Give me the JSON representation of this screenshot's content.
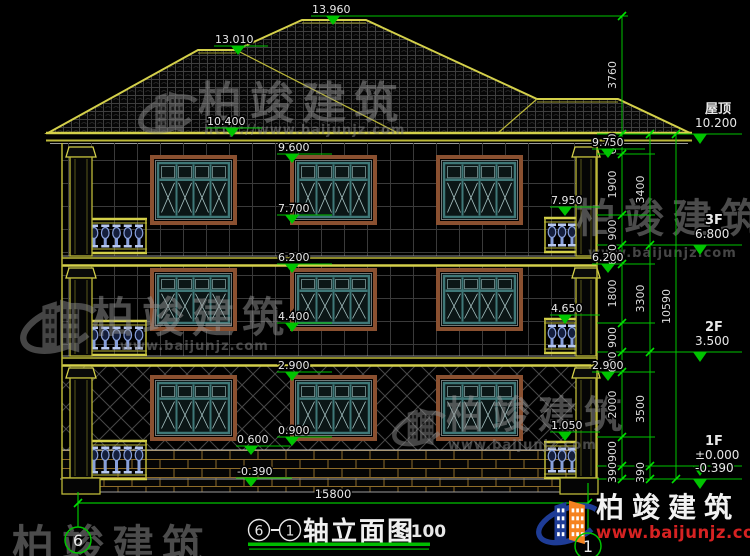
{
  "canvas": {
    "width": 750,
    "height": 556,
    "background": "#000000"
  },
  "colors": {
    "dim_green": "#00c400",
    "tick_green": "#00e000",
    "outline_yellow": "#bcb838",
    "bright_yellow": "#d4d04a",
    "text_white": "#e8e8e8",
    "frame_brown": "#8a5030",
    "sash_teal": "#3f7878",
    "pane_fill": "#0b1616",
    "mullion_light": "#a8c4c4",
    "wall_grid": "#3a3a3a",
    "hatch_grey": "#4a4a4a",
    "roof_tile": "#3e3e3e",
    "brick_mortar": "#8f6d2a",
    "baluster_blue": "#88a0dc",
    "baluster_light": "#b8c8ee",
    "watermark_grey": "#969696",
    "brand_red": "#d62222",
    "brand_blue": "#1e3c96",
    "brand_orange": "#f5821f"
  },
  "title_block": {
    "axis_start": "6",
    "axis_end": "1",
    "separator": "-",
    "title": "轴立面图",
    "scale": "1:100"
  },
  "brand": {
    "name": "柏竣建筑",
    "url": "www.baijunjz.com"
  },
  "watermarks": [
    {
      "text": "柏竣建筑",
      "url": "http://www.baijunjz.com",
      "x": 198,
      "y": 118,
      "size": 44,
      "url_x": 204,
      "url_y": 134,
      "logo": {
        "x": 138,
        "y": 78,
        "s": 0.62
      }
    },
    {
      "text": "柏竣建筑",
      "url": "www.baijunjz.com",
      "x": 92,
      "y": 332,
      "size": 42,
      "url_x": 120,
      "url_y": 350,
      "logo": {
        "x": 20,
        "y": 282,
        "s": 0.8
      }
    },
    {
      "text": "柏竣建筑",
      "url": "www.baijunjz.com",
      "x": 576,
      "y": 232,
      "size": 40,
      "url_x": 588,
      "url_y": 257
    },
    {
      "text": "柏竣建筑",
      "url": "www.baijunjz.com",
      "x": 446,
      "y": 428,
      "size": 38,
      "url_x": 448,
      "url_y": 449,
      "logo": {
        "x": 392,
        "y": 396,
        "s": 0.56
      }
    },
    {
      "text": "柏竣建筑",
      "url": "",
      "x": 12,
      "y": 560,
      "size": 42
    }
  ],
  "elevation_markers": [
    {
      "t": "13.960",
      "y": 16,
      "ax": 333,
      "x1": 311,
      "x2": 368,
      "tx": 312
    },
    {
      "t": "13.010",
      "y": 46,
      "ax": 238,
      "x1": 214,
      "x2": 268,
      "tx": 215
    },
    {
      "t": "10.400",
      "y": 128,
      "ax": 232,
      "x1": 206,
      "x2": 262,
      "tx": 207
    },
    {
      "t": "9.600",
      "y": 154,
      "ax": 292,
      "x1": 277,
      "x2": 332,
      "tx": 278
    },
    {
      "t": "7.700",
      "y": 215,
      "ax": 292,
      "x1": 277,
      "x2": 332,
      "tx": 278
    },
    {
      "t": "6.200",
      "y": 264,
      "ax": 292,
      "x1": 277,
      "x2": 332,
      "tx": 278
    },
    {
      "t": "4.400",
      "y": 323,
      "ax": 292,
      "x1": 277,
      "x2": 332,
      "tx": 278
    },
    {
      "t": "2.900",
      "y": 372,
      "ax": 292,
      "x1": 277,
      "x2": 332,
      "tx": 278
    },
    {
      "t": "0.900",
      "y": 437,
      "ax": 292,
      "x1": 277,
      "x2": 332,
      "tx": 278
    },
    {
      "t": "0.600",
      "y": 446,
      "ax": 251,
      "x1": 236,
      "x2": 290,
      "tx": 237
    },
    {
      "t": "-0.390",
      "y": 478,
      "ax": 251,
      "x1": 236,
      "x2": 292,
      "tx": 237
    },
    {
      "t": "7.950",
      "y": 207,
      "ax": 565,
      "x1": 550,
      "x2": 600,
      "tx": 551
    },
    {
      "t": "4.650",
      "y": 315,
      "ax": 565,
      "x1": 550,
      "x2": 600,
      "tx": 551
    },
    {
      "t": "1.050",
      "y": 432,
      "ax": 565,
      "x1": 550,
      "x2": 600,
      "tx": 551
    },
    {
      "t": "9.750",
      "y": 149,
      "ax": 608,
      "x1": 592,
      "x2": 645,
      "tx": 592
    },
    {
      "t": "6.200",
      "y": 264,
      "ax": 608,
      "x1": 592,
      "x2": 645,
      "tx": 592
    },
    {
      "t": "2.900",
      "y": 372,
      "ax": 608,
      "x1": 592,
      "x2": 645,
      "tx": 592
    }
  ],
  "floor_levels": [
    {
      "name": "屋顶",
      "value": "10.200",
      "y": 134
    },
    {
      "name": "3F",
      "value": "6.800",
      "y": 245
    },
    {
      "name": "2F",
      "value": "3.500",
      "y": 352
    },
    {
      "name": "1F",
      "value": "±0.000",
      "y": 466
    },
    {
      "name": "",
      "value": "-0.390",
      "y": 479
    }
  ],
  "dim_chains": [
    {
      "x": 622,
      "segs": [
        [
          16,
          134,
          "3760"
        ],
        [
          134,
          154,
          "600"
        ],
        [
          154,
          215,
          "1900"
        ],
        [
          215,
          245,
          "900"
        ],
        [
          245,
          264,
          "600"
        ],
        [
          264,
          323,
          "1800"
        ],
        [
          323,
          352,
          "900"
        ],
        [
          352,
          372,
          "600"
        ],
        [
          372,
          437,
          "2000"
        ],
        [
          437,
          466,
          "900"
        ],
        [
          466,
          479,
          "390"
        ]
      ]
    },
    {
      "x": 650,
      "segs": [
        [
          134,
          245,
          "3400"
        ],
        [
          245,
          352,
          "3300"
        ],
        [
          352,
          466,
          "3500"
        ],
        [
          466,
          479,
          "390"
        ]
      ]
    },
    {
      "x": 676,
      "segs": [
        [
          134,
          479,
          "10590"
        ]
      ]
    }
  ],
  "connectors": [
    {
      "y": 16,
      "x1": 345,
      "x2": 628
    },
    {
      "y": 134,
      "x1": 597,
      "x2": 742
    },
    {
      "y": 245,
      "x1": 597,
      "x2": 742
    },
    {
      "y": 352,
      "x1": 597,
      "x2": 742
    },
    {
      "y": 466,
      "x1": 597,
      "x2": 742
    },
    {
      "y": 479,
      "x1": 597,
      "x2": 742
    },
    {
      "y": 154,
      "x1": 597,
      "x2": 655
    },
    {
      "y": 215,
      "x1": 597,
      "x2": 655
    },
    {
      "y": 264,
      "x1": 597,
      "x2": 655
    },
    {
      "y": 323,
      "x1": 597,
      "x2": 655
    },
    {
      "y": 372,
      "x1": 597,
      "x2": 655
    },
    {
      "y": 437,
      "x1": 597,
      "x2": 655
    }
  ],
  "bottom_dimension": {
    "label": "15800",
    "x1": 78,
    "x2": 588,
    "y": 503,
    "text_x": 333,
    "text_y": 498
  },
  "axis_bubbles": [
    {
      "label": "6",
      "cx": 78,
      "cy": 540,
      "r": 13,
      "line_y1": 492,
      "line_y2": 527
    },
    {
      "label": "1",
      "cx": 588,
      "cy": 546,
      "r": 13,
      "line_y1": 483,
      "line_y2": 533
    }
  ],
  "building": {
    "roof": {
      "outline": [
        [
          48,
          133
        ],
        [
          198,
          50
        ],
        [
          236,
          50
        ],
        [
          302,
          20
        ],
        [
          366,
          20
        ],
        [
          537,
          99
        ],
        [
          618,
          99
        ],
        [
          690,
          133
        ]
      ],
      "hips": [
        [
          236,
          50,
          398,
          133
        ],
        [
          537,
          99,
          498,
          133
        ]
      ],
      "ridge_doubles": [
        [
          198,
          53,
          236,
          53
        ],
        [
          302,
          23,
          366,
          23
        ],
        [
          537,
          102,
          618,
          102
        ]
      ],
      "eave": {
        "x1": 46,
        "x2": 692
      }
    },
    "facade": {
      "x1": 62,
      "x2": 597,
      "top": 143,
      "wall_bottom": 450,
      "brick_bottom": 492,
      "ground_y": 479
    },
    "floors": [
      {
        "y1": 143,
        "y2": 256,
        "pattern": "grid"
      },
      {
        "y1": 266,
        "y2": 356,
        "pattern": "grid"
      },
      {
        "y1": 366,
        "y2": 450,
        "pattern": "diamond"
      }
    ],
    "bands": [
      {
        "y": 256
      },
      {
        "y": 356
      }
    ],
    "windows": [
      {
        "x": 150,
        "y": 155,
        "w": 87,
        "h": 70
      },
      {
        "x": 290,
        "y": 155,
        "w": 87,
        "h": 70
      },
      {
        "x": 436,
        "y": 155,
        "w": 87,
        "h": 70
      },
      {
        "x": 150,
        "y": 268,
        "w": 87,
        "h": 63
      },
      {
        "x": 290,
        "y": 268,
        "w": 87,
        "h": 63
      },
      {
        "x": 436,
        "y": 268,
        "w": 87,
        "h": 63
      },
      {
        "x": 150,
        "y": 375,
        "w": 87,
        "h": 66
      },
      {
        "x": 290,
        "y": 375,
        "w": 87,
        "h": 66
      },
      {
        "x": 436,
        "y": 375,
        "w": 87,
        "h": 66
      }
    ],
    "balconies": [
      {
        "x": 86,
        "y": 218,
        "w": 61,
        "h": 36
      },
      {
        "x": 544,
        "y": 217,
        "w": 36,
        "h": 36
      },
      {
        "x": 86,
        "y": 320,
        "w": 61,
        "h": 36
      },
      {
        "x": 544,
        "y": 318,
        "w": 36,
        "h": 36
      },
      {
        "x": 86,
        "y": 440,
        "w": 61,
        "h": 40
      },
      {
        "x": 544,
        "y": 441,
        "w": 36,
        "h": 38
      }
    ],
    "pilasters": [
      {
        "x": 70,
        "w": 22,
        "segs": [
          [
            147,
            256
          ],
          [
            268,
            356
          ],
          [
            368,
            478
          ]
        ],
        "base": [
          62,
          478,
          38,
          16
        ]
      },
      {
        "x": 576,
        "w": 20,
        "segs": [
          [
            147,
            256
          ],
          [
            268,
            356
          ],
          [
            368,
            478
          ]
        ],
        "base": [
          560,
          478,
          38,
          16
        ]
      }
    ]
  }
}
